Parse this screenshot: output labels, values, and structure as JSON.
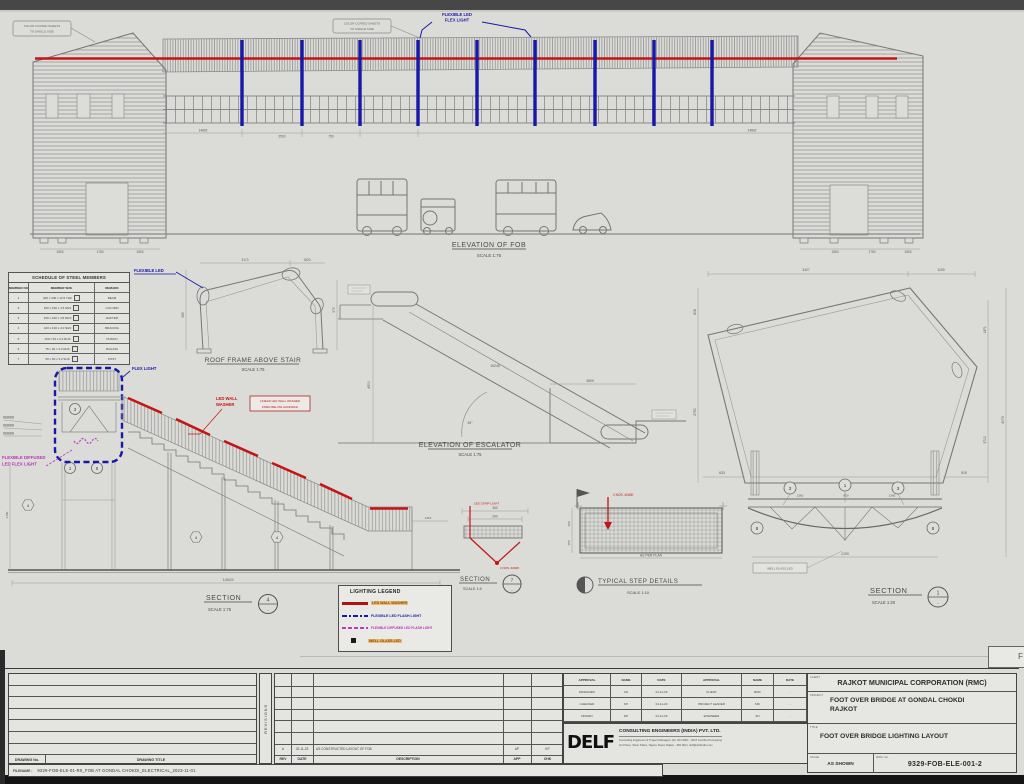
{
  "meta": {
    "corner_letter": "F"
  },
  "colors": {
    "red": "#c41414",
    "blue": "#1718a8",
    "magenta": "#c03ac0",
    "legend_highlight": "#e9a436"
  },
  "views": {
    "fob": {
      "title": "ELEVATION OF FOB",
      "scale": "SCALE  1:75"
    },
    "frame": {
      "title": "ROOF FRAME ABOVE STAIR",
      "scale": "SCALE  1:75"
    },
    "esc": {
      "title": "ELEVATION OF ESCALATOR",
      "scale": "SCALE  1:75"
    },
    "sec1": {
      "title": "SECTION",
      "scale": "SCALE  1:20",
      "num": "1",
      "dash": "-"
    },
    "sec4": {
      "title": "SECTION",
      "scale": "SCALE  1:75",
      "num": "4",
      "dash": "-"
    },
    "sec7": {
      "title": "SECTION",
      "scale": "SCALE  1:5",
      "num": "7",
      "dash": "-"
    },
    "steps": {
      "title": "TYPICAL STEP DETAILS",
      "scale": "SCALE  1:10"
    }
  },
  "ann": {
    "flex_top1": "FLEXIBLE LED",
    "flex_top2": "FLEX LIGHT",
    "flex_mid": "FLEXIBLE LED",
    "flex_stair": "FLEX LIGHT",
    "lww1": "LED WALL",
    "lww2": "WASHER",
    "lww_note1": "LINEAR LED WALL WASHER",
    "lww_note2": "FIXED BELOW HANDRAIL",
    "fd1": "FLEXIBLE DIFFUSED",
    "fd2": "LED FLEX LIGHT",
    "roof1": "COLOR COATED SHEETS",
    "roof2": "TO SINGLE SIDE",
    "wg": "WELL GLASS LED",
    "red7a": "LED STRIP LIGHT",
    "red7b": "2 NOS. 4000K",
    "red10": "2 NOS. 4000K"
  },
  "dims": {
    "bridge_left": "14802",
    "bridge_mid": "2500",
    "bridge_mid2": "750",
    "bridge_right": "14802",
    "t1": "1500",
    "t2": "1750",
    "t3": "1500",
    "frame_top1": "3170",
    "frame_top2": "1520",
    "frame_left": "965",
    "frame_right": "975",
    "esc_len": "10245",
    "esc_h": "4500",
    "esc_pit": "4509",
    "esc_ang": "45°",
    "pent_top1": "3427",
    "pent_top2": "1190",
    "pent_left1": "808",
    "pent_left2": "2790",
    "pent_right1": "1471",
    "pent_right2": "3702",
    "pent_right3": "4073",
    "pent_b1": "633",
    "pent_b2": "915",
    "deck1": "1360",
    "deck2": "830",
    "deck3": "1360",
    "width": "2190",
    "stair_len": "14025",
    "stair_h": "3150",
    "stair_r": "1415",
    "step_w": "360",
    "step_w2": "290",
    "step_h1": "300",
    "step_h2": "150",
    "plan": "AS PER PLAN"
  },
  "call": {
    "p1": "3",
    "p2": "1",
    "p3": "3",
    "p4": "8",
    "p5": "8",
    "s1": "3",
    "s2": "1",
    "s3": "5",
    "h1": "4",
    "h2": "4",
    "h3": "4"
  },
  "schedule": {
    "title": "SCHEDULE OF STEEL MEMBERS",
    "headers": [
      "MEMBER NO",
      "MEMBER SIZE",
      "REMARK"
    ],
    "rows": [
      {
        "no": "1",
        "size": "400 x 200 x 12.5 THK",
        "remark": "BEAM"
      },
      {
        "no": "2",
        "size": "150 x 150 x 4.5 SHS",
        "remark": "COLUMN"
      },
      {
        "no": "3",
        "size": "150 x 100 x 4.5 RHS",
        "remark": "RAFTER"
      },
      {
        "no": "4",
        "size": "100 x 100 x 4.0 SHS",
        "remark": "BRACING"
      },
      {
        "no": "5",
        "size": "100 x 50 x 3.2 RHS",
        "remark": "PURLIN"
      },
      {
        "no": "6",
        "size": "75 x 40 x 3.2 RHS",
        "remark": "RAILING"
      },
      {
        "no": "7",
        "size": "50 x 50 x 3.2 SHS",
        "remark": "POST"
      }
    ]
  },
  "legend": {
    "title": "LIGHTING LEGEND",
    "items": [
      {
        "label": "LED WALL WASHER"
      },
      {
        "label": "FLEXIBLE LED FLASH LIGHT"
      },
      {
        "label": "FLEXIBLE DIFFUSED LED FLASH LIGHT"
      },
      {
        "label": "WELL GLASS LED"
      }
    ]
  },
  "tb": {
    "index_headers": [
      "DRAWING No.",
      "DRAWING TITLE"
    ],
    "revisions": "REVISIONS",
    "rev_headers": [
      "REV",
      "DATE",
      "DESCRIPTION",
      "APP",
      "CHK"
    ],
    "rev_entry": [
      "A",
      "02-11-23",
      "AS CONSTRUCTED LAYOUT OF FOB",
      "AP",
      "KP"
    ],
    "app_headers": [
      "APPROVAL",
      "NAME",
      "DATE",
      "APPROVAL",
      "NAME",
      "DATE"
    ],
    "app_rows": [
      [
        "DESIGNED",
        "AN",
        "01-11-23",
        "CLIENT",
        "RMC",
        "-"
      ],
      [
        "CHECKED",
        "KP",
        "01-11-23",
        "PROJECT LEADER",
        "MD",
        "-"
      ],
      [
        "DRAWN",
        "DP",
        "01-11-23",
        "ENGINEER",
        "SN",
        "-"
      ]
    ],
    "delf": {
      "logo": "DELF",
      "name": "CONSULTING ENGINEERS (INDIA) PVT. LTD.",
      "tag": "Consulting Engineers & Project Managers (An ISO 9001 : 2015 Certified Company)",
      "addr": "2nd Floor, Silver Plaza, Tagore Road, Rajkot - 360 002  |  delf@delfindia.com"
    },
    "client_label": "CLIENT",
    "client": "RAJKOT MUNICIPAL CORPORATION (RMC)",
    "project_label": "PROJECT",
    "project1": "FOOT OVER BRIDGE AT GONDAL CHOKDI",
    "project2": "RAJKOT",
    "title_label": "TITLE",
    "title": "FOOT OVER BRIDGE LIGHTING LAYOUT",
    "scale_label": "SCALE",
    "scale": "AS SHOWN",
    "dwg_label": "DWG. No.",
    "dwg": "9329-FOB-ELE-001-2",
    "file_label": "FILENAME :",
    "file": "9329-FOB-ELE-01-R0_FOB AT GONDAL CHOKDI_ELECTRICAL_2023-11-01"
  }
}
